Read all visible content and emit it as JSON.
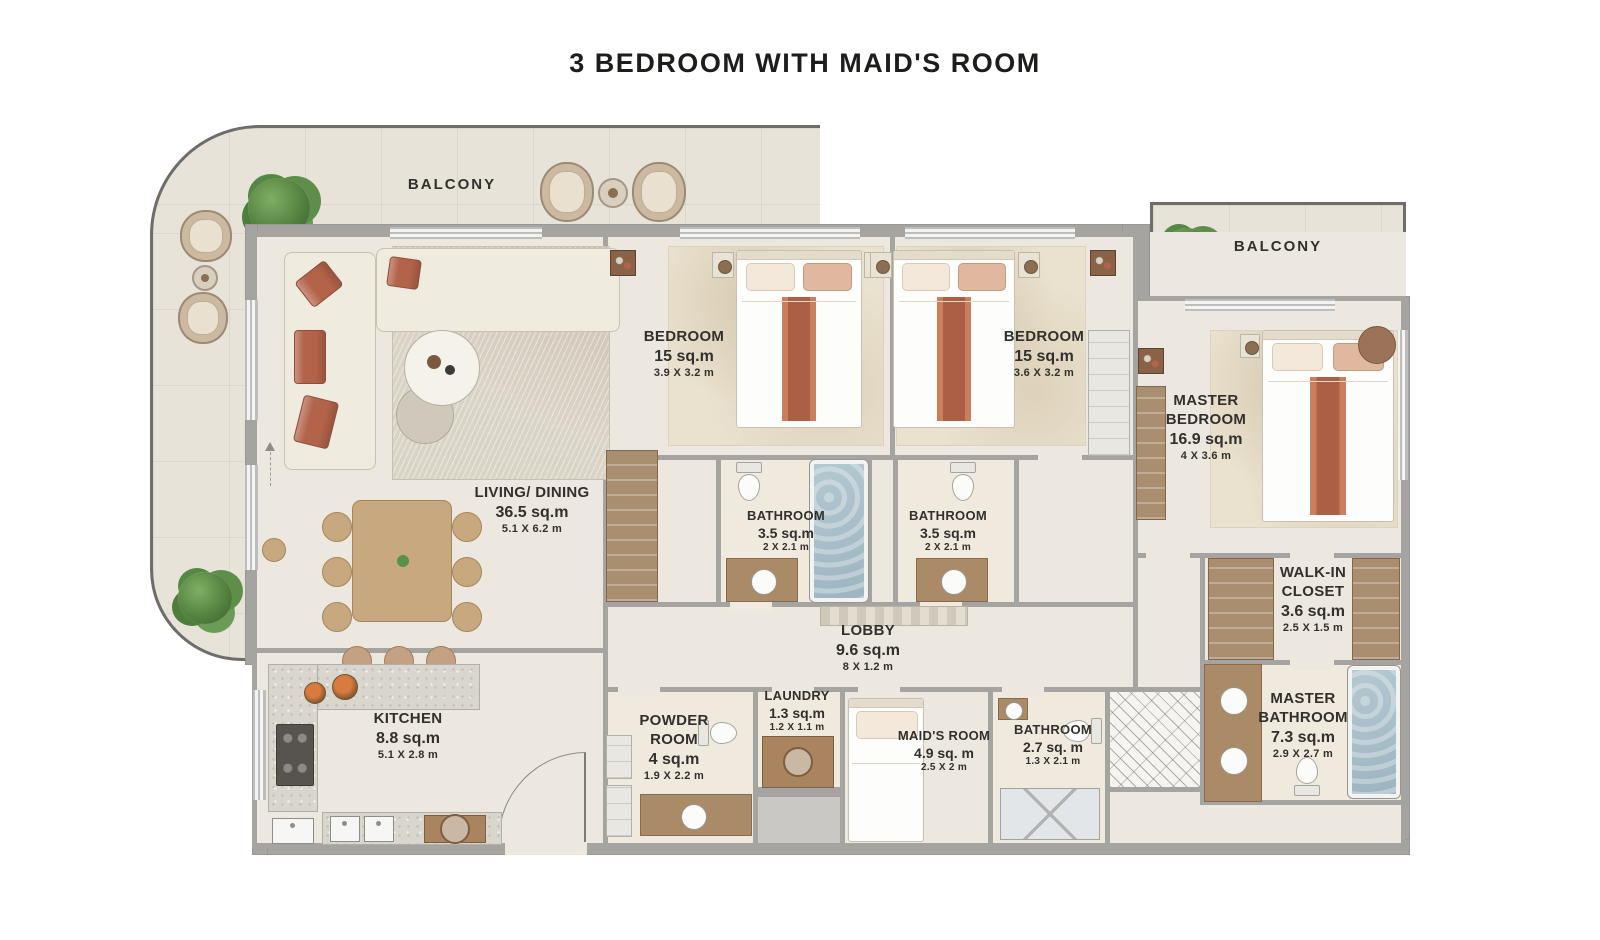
{
  "title": "3 BEDROOM WITH MAID'S ROOM",
  "colors": {
    "wall_gray": "#a5a4a1",
    "floor_cream": "#ece8df",
    "balcony_tile": "#e7e3d8",
    "accent_terracotta": "#b3634a",
    "bathtub_water_blue": "#a9bfc9",
    "wood_brown": "#a98e6f",
    "plant_green": "#5d8f4a",
    "text": "#32302c"
  },
  "rooms": [
    {
      "id": "balcony-main",
      "name": "BALCONY",
      "area": "",
      "dims": ""
    },
    {
      "id": "balcony-master",
      "name": "BALCONY",
      "area": "",
      "dims": ""
    },
    {
      "id": "living-dining",
      "name": "LIVING/ DINING",
      "area": "36.5 sq.m",
      "dims": "5.1 X 6.2 m"
    },
    {
      "id": "bedroom-1",
      "name": "BEDROOM",
      "area": "15 sq.m",
      "dims": "3.9 X 3.2 m"
    },
    {
      "id": "bedroom-2",
      "name": "BEDROOM",
      "area": "15 sq.m",
      "dims": "3.6 X 3.2 m"
    },
    {
      "id": "master-bedroom",
      "name": "MASTER BEDROOM",
      "area": "16.9 sq.m",
      "dims": "4 X 3.6 m"
    },
    {
      "id": "bathroom-1",
      "name": "BATHROOM",
      "area": "3.5 sq.m",
      "dims": "2 X 2.1 m"
    },
    {
      "id": "bathroom-2",
      "name": "BATHROOM",
      "area": "3.5 sq.m",
      "dims": "2 X 2.1 m"
    },
    {
      "id": "lobby",
      "name": "LOBBY",
      "area": "9.6 sq.m",
      "dims": "8 X 1.2 m"
    },
    {
      "id": "laundry",
      "name": "LAUNDRY",
      "area": "1.3 sq.m",
      "dims": "1.2 X 1.1 m"
    },
    {
      "id": "powder-room",
      "name": "POWDER ROOM",
      "area": "4 sq.m",
      "dims": "1.9 X 2.2 m"
    },
    {
      "id": "maids-room",
      "name": "MAID'S ROOM",
      "area": "4.9 sq. m",
      "dims": "2.5 X 2 m"
    },
    {
      "id": "maids-bathroom",
      "name": "BATHROOM",
      "area": "2.7 sq. m",
      "dims": "1.3 X 2.1 m"
    },
    {
      "id": "kitchen",
      "name": "KITCHEN",
      "area": "8.8 sq.m",
      "dims": "5.1 X 2.8 m"
    },
    {
      "id": "walk-in-closet",
      "name": "WALK-IN CLOSET",
      "area": "3.6 sq.m",
      "dims": "2.5 X 1.5 m"
    },
    {
      "id": "master-bathroom",
      "name": "MASTER BATHROOM",
      "area": "7.3 sq.m",
      "dims": "2.9 X 2.7 m"
    }
  ]
}
